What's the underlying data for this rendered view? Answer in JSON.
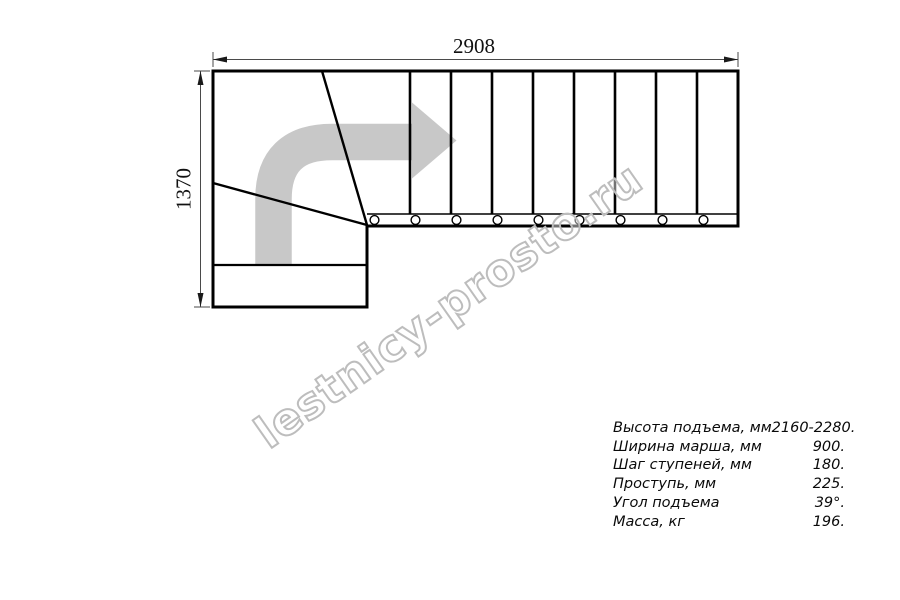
{
  "drawing": {
    "title": "staircase-plan-view",
    "top_dimension": "2908",
    "left_dimension": "1370",
    "step_count_straight": 9,
    "winder_steps": 3,
    "colors": {
      "line": "#000000",
      "dimension_line": "#4a4a4a",
      "arrow_fill": "#c8c8c8",
      "watermark_stroke": "#bdbdbd"
    }
  },
  "watermark": {
    "text": "lestnicy-prosto.ru"
  },
  "specs": {
    "rows": [
      {
        "label": "Высота подъема, мм",
        "value": "2160-2280."
      },
      {
        "label": "Ширина марша, мм",
        "value": "900."
      },
      {
        "label": "Шаг ступеней, мм",
        "value": "180."
      },
      {
        "label": "Проступь, мм",
        "value": "225."
      },
      {
        "label": "Угол подъема",
        "value": "39°."
      },
      {
        "label": "Масса, кг",
        "value": "196."
      }
    ]
  }
}
